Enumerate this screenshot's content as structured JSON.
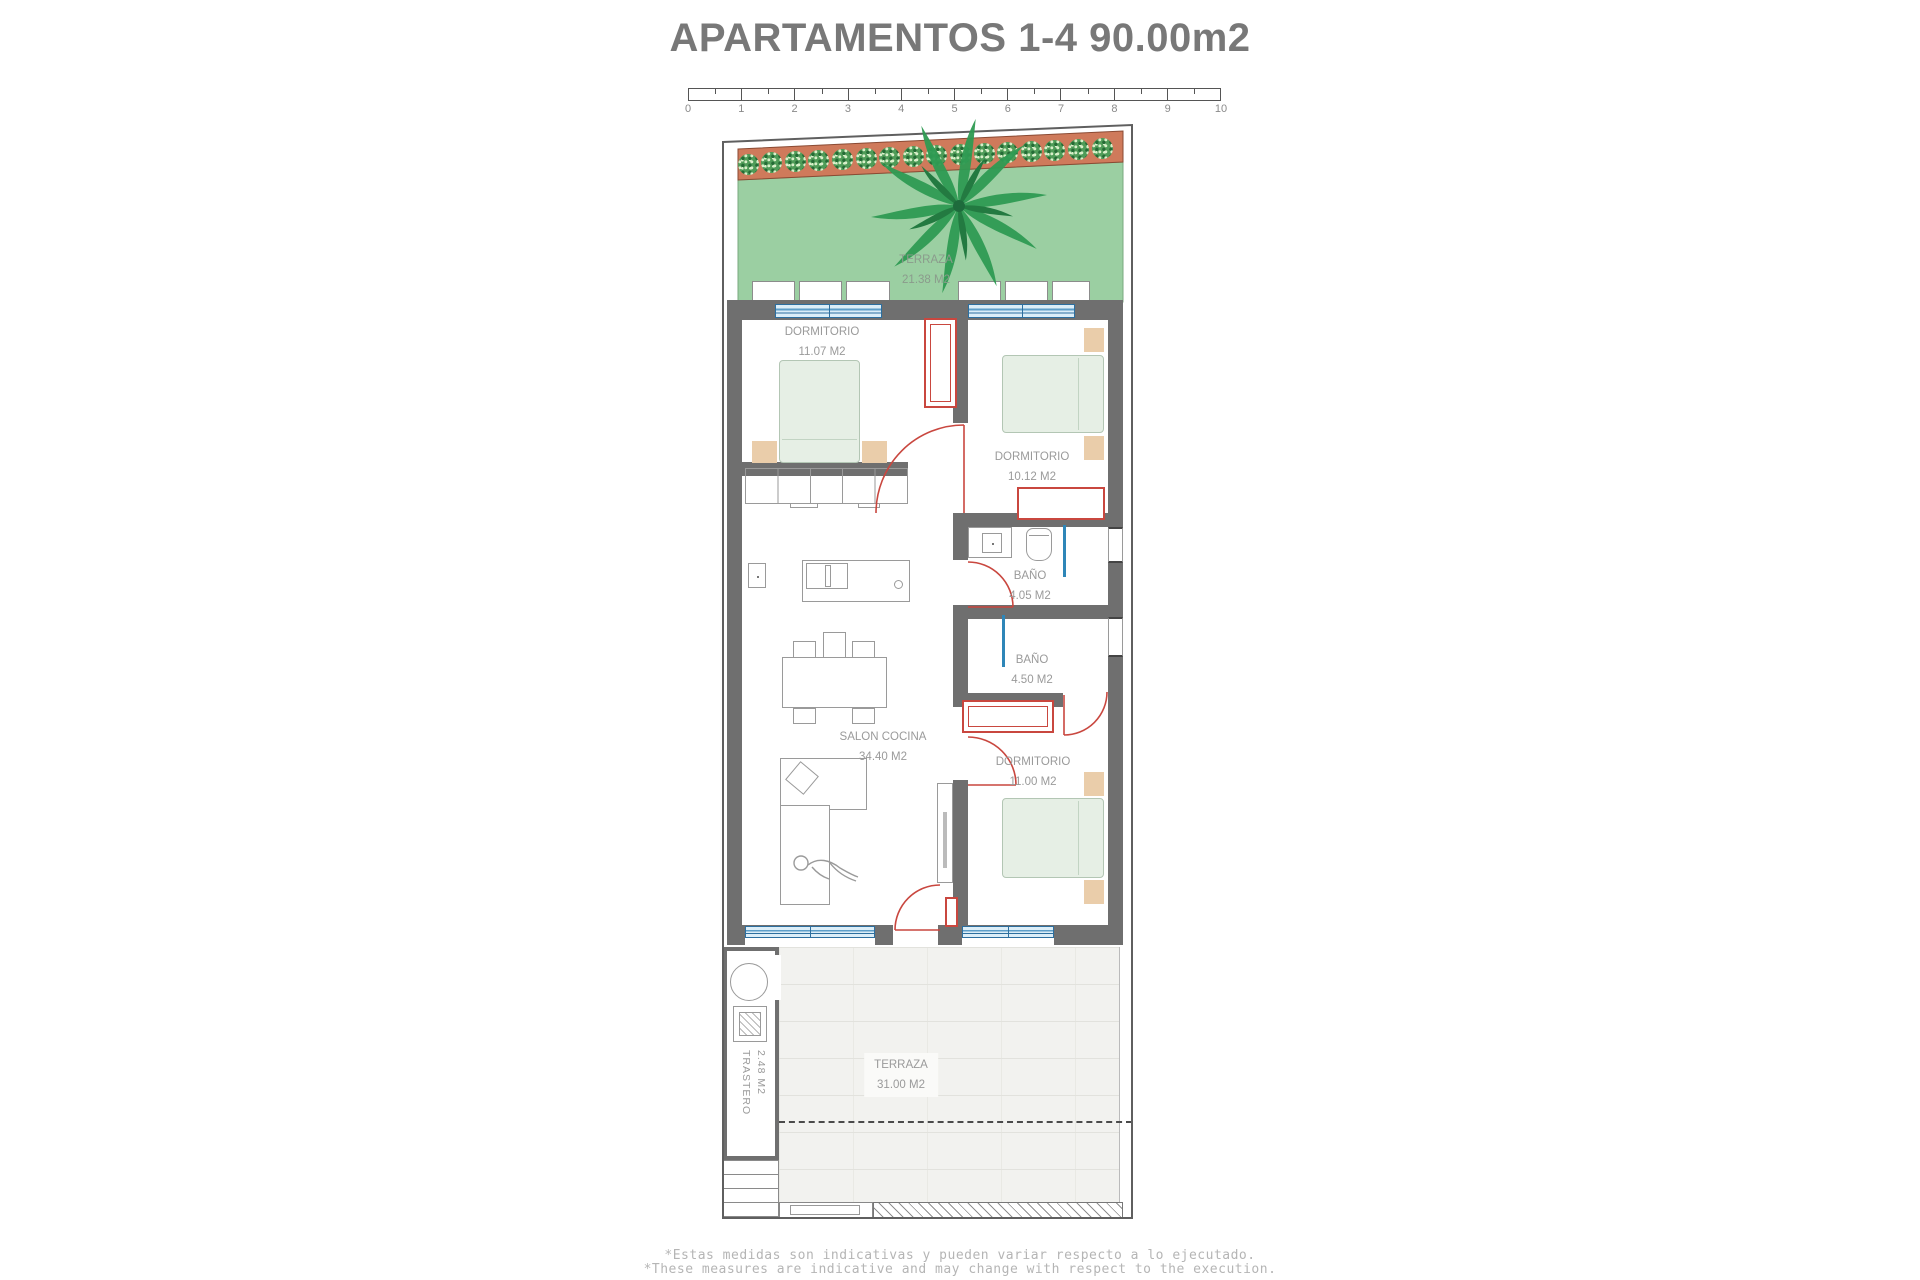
{
  "title": "APARTAMENTOS 1-4  90.00m2",
  "scale_bar": {
    "unit_labels": [
      "0",
      "1",
      "2",
      "3",
      "4",
      "5",
      "6",
      "7",
      "8",
      "9",
      "10"
    ]
  },
  "plan": {
    "rooms": {
      "terraza_top": {
        "name": "TERRAZA",
        "area": "21.38 M2"
      },
      "dormitorio_1": {
        "name": "DORMITORIO",
        "area": "11.07 M2"
      },
      "dormitorio_2": {
        "name": "DORMITORIO",
        "area": "10.12 M2"
      },
      "bano_1": {
        "name": "BAÑO",
        "area": "4.05 M2"
      },
      "bano_2": {
        "name": "BAÑO",
        "area": "4.50 M2"
      },
      "salon_cocina": {
        "name": "SALON COCINA",
        "area": "34.40 M2"
      },
      "dormitorio_3": {
        "name": "DORMITORIO",
        "area": "11.00 M2"
      },
      "terraza_bottom": {
        "name": "TERRAZA",
        "area": "31.00 M2"
      },
      "trastero": {
        "name": "TRASTERO",
        "area": "2.48 M2"
      }
    }
  },
  "footnotes": {
    "line1": "*Estas medidas son indicativas y pueden variar respecto a lo ejecutado.",
    "line2": "*These measures are indicative and may change with respect to the execution."
  },
  "colors": {
    "terrace_green": "#9bcfa2",
    "planter_terracotta": "#cf7a5b",
    "bush_green": "#4f9c58",
    "wall_gray": "#6f6f6f",
    "door_red": "#c9473f",
    "window_blue": "#2d6f9f",
    "shower_blue": "#2e86b8",
    "bed_fill": "#e6efe5",
    "nightstand_tan": "#eacdaa",
    "tile_gray": "#f2f2ef",
    "label_gray": "#9a9a9a",
    "title_gray": "#787878"
  }
}
